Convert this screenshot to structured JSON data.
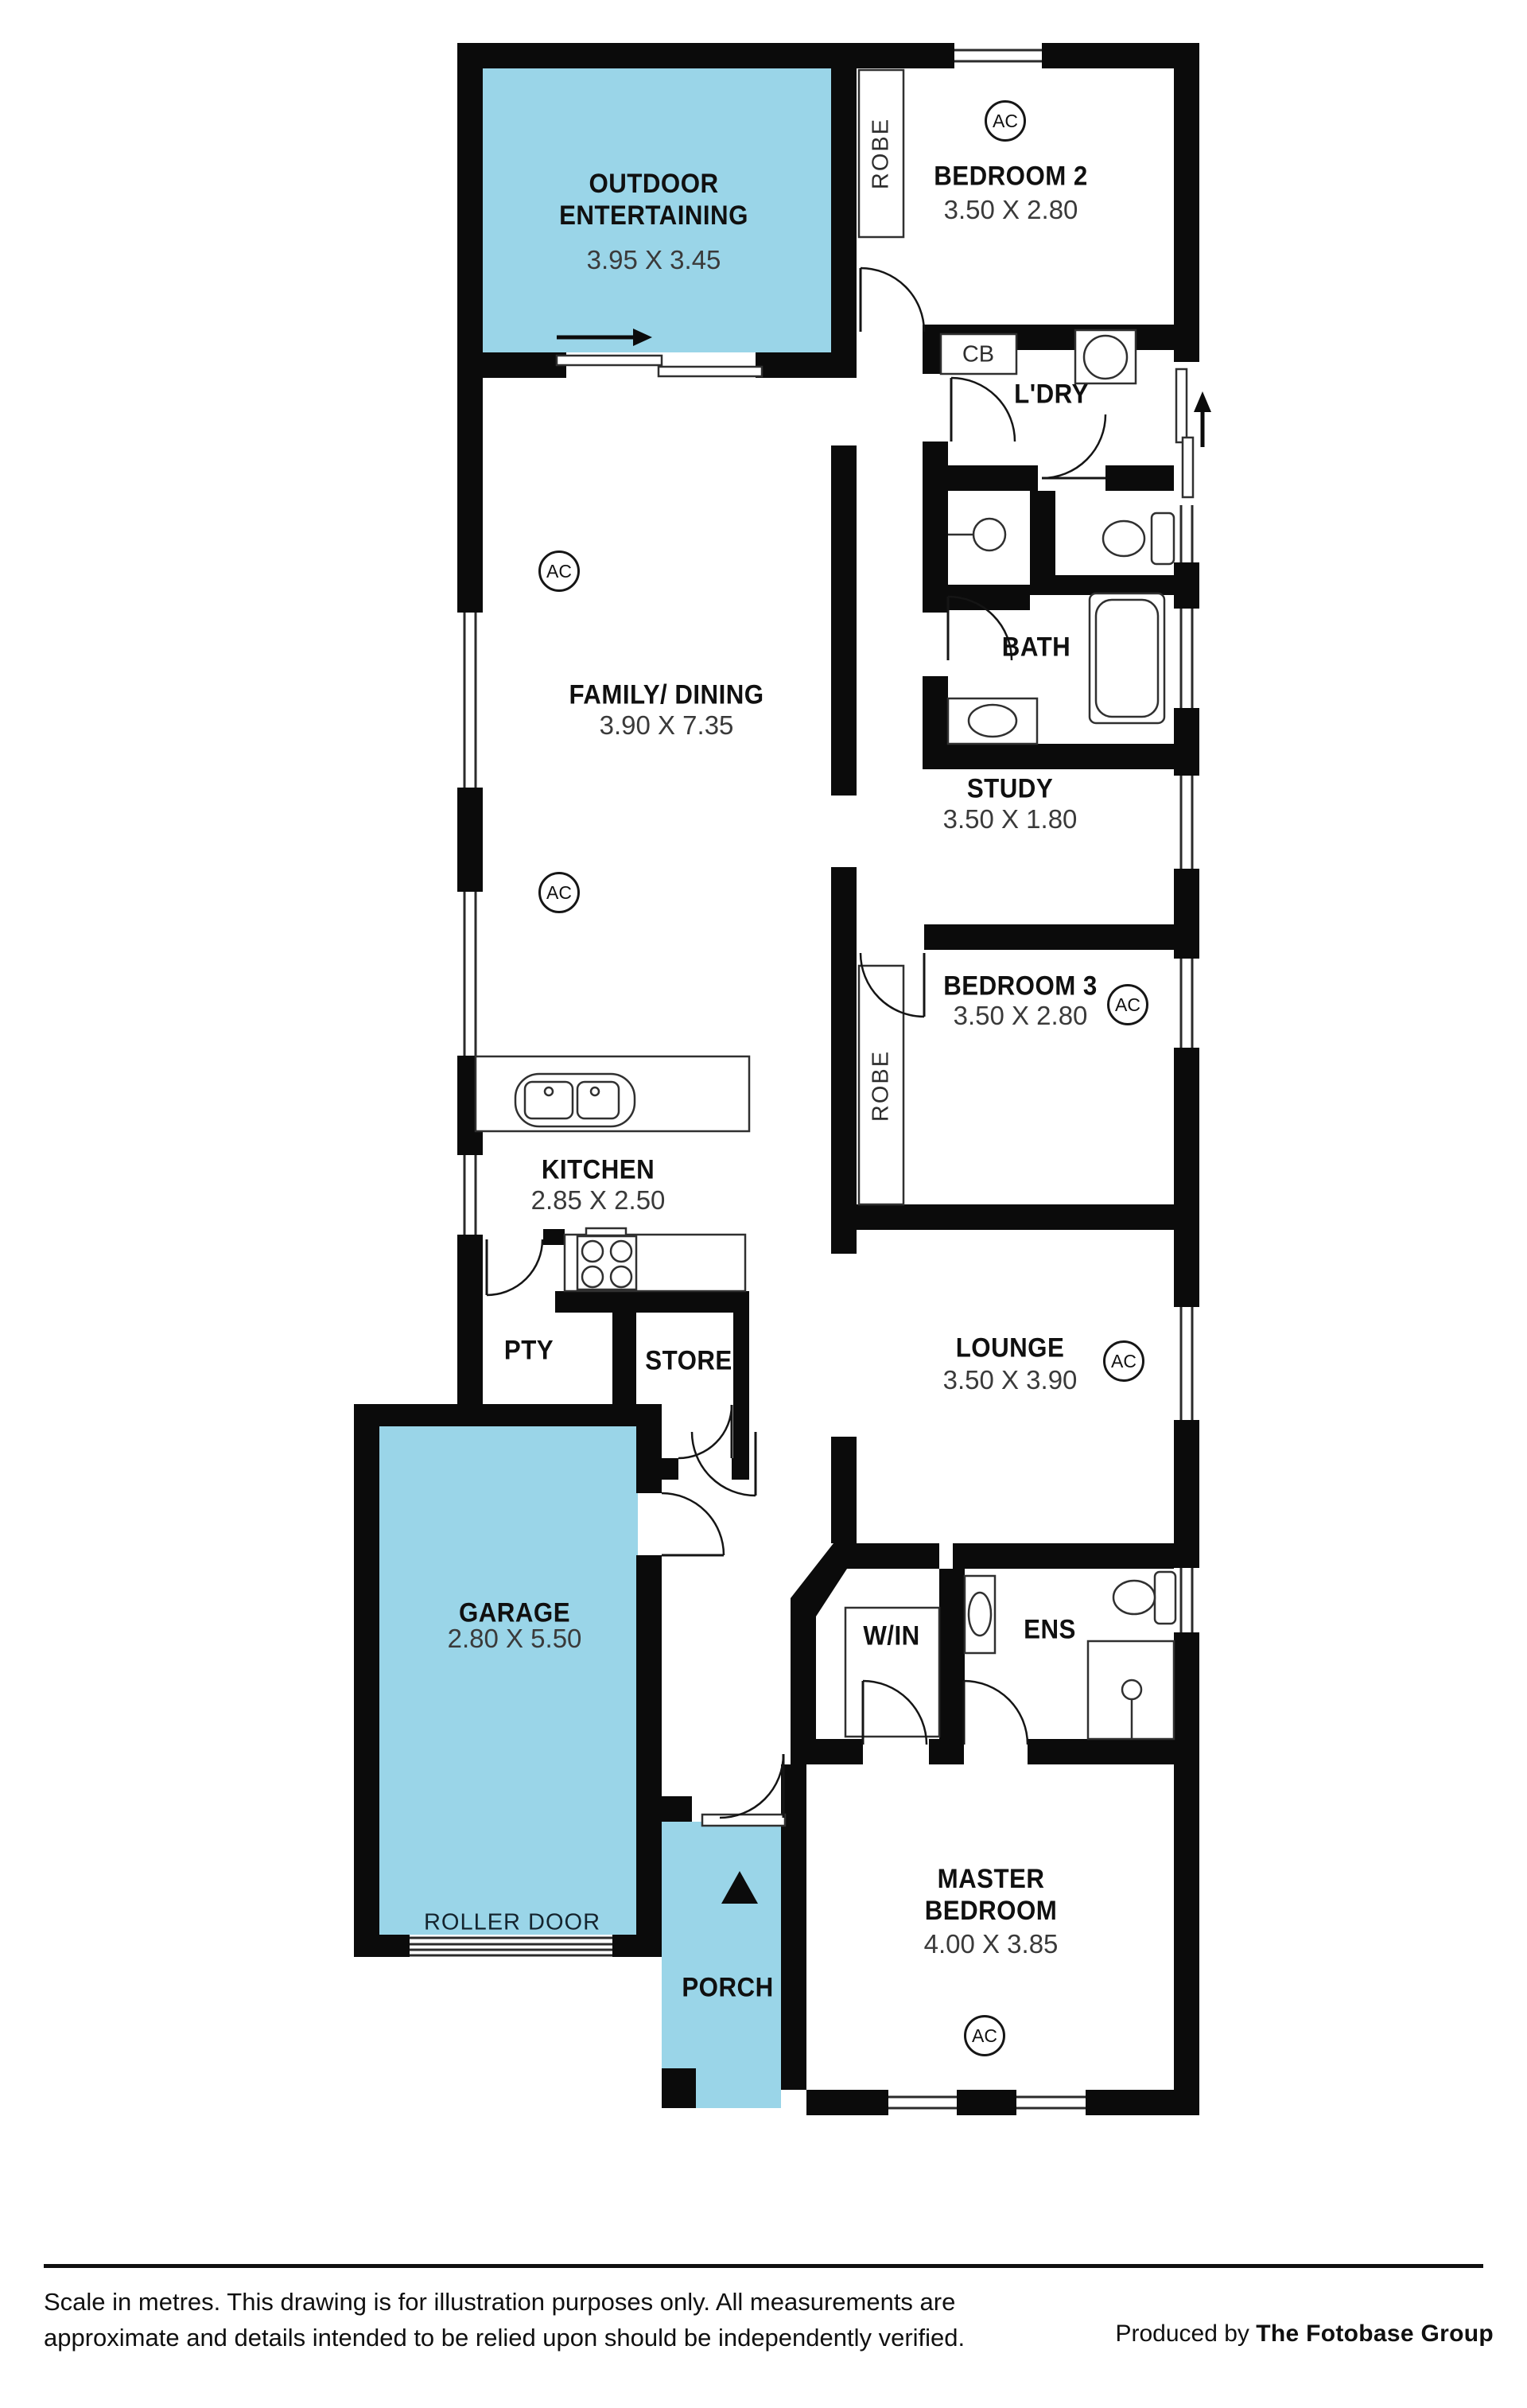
{
  "rooms": {
    "outdoor": {
      "name": "OUTDOOR ENTERTAINING",
      "dims": "3.95 X 3.45"
    },
    "bedroom2": {
      "name": "BEDROOM 2",
      "dims": "3.50 X 2.80"
    },
    "laundry": {
      "name": "L'DRY"
    },
    "bath": {
      "name": "BATH"
    },
    "study": {
      "name": "STUDY",
      "dims": "3.50 X 1.80"
    },
    "bedroom3": {
      "name": "BEDROOM 3",
      "dims": "3.50 X 2.80"
    },
    "family": {
      "name": "FAMILY/ DINING",
      "dims": "3.90 X 7.35"
    },
    "kitchen": {
      "name": "KITCHEN",
      "dims": "2.85 X 2.50"
    },
    "pantry": {
      "name": "PTY"
    },
    "store": {
      "name": "STORE"
    },
    "lounge": {
      "name": "LOUNGE",
      "dims": "3.50 X 3.90"
    },
    "garage": {
      "name": "GARAGE",
      "dims": "2.80 X 5.50"
    },
    "walkin": {
      "name": "W/IN"
    },
    "ensuite": {
      "name": "ENS"
    },
    "master": {
      "name": "MASTER BEDROOM",
      "dims": "4.00 X 3.85"
    },
    "porch": {
      "name": "PORCH"
    }
  },
  "markers": {
    "ac": "AC",
    "robe": "ROBE",
    "cupboard": "CB",
    "roller_door": "ROLLER DOOR"
  },
  "colors": {
    "highlight": "#9AD5E8",
    "wall": "#0B0B0B"
  },
  "footer": {
    "disclaimer_line1": "Scale in metres. This drawing is for illustration purposes only. All measurements are",
    "disclaimer_line2": "approximate and details intended to be relied upon should be independently verified.",
    "produced_prefix": "Produced by ",
    "produced_name": "The Fotobase Group"
  }
}
